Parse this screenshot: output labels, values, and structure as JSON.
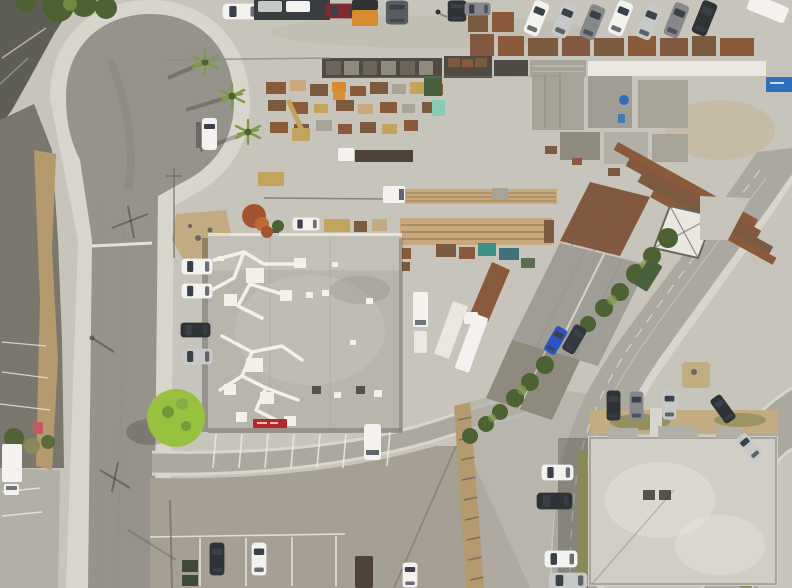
{
  "meta": {
    "subject": "Top-down aerial drone photograph of an industrial lumber yard and warehouse block with surrounding streets, a cul-de-sac, rooftops with HVAC ducting, and many parked vehicles",
    "view": "nadir (straight down)",
    "dimensions": "792x588"
  },
  "palette": {
    "concrete": "#c7c4bb",
    "concreteLight": "#d8d5cc",
    "concreteDark": "#b2afa6",
    "asphalt": "#96938c",
    "asphaltDark": "#7a776f",
    "hill": "#5f5e55",
    "lotBottom": "#a59f94",
    "roadDiag": "#aba8a0",
    "roofMain": "#b8b5ac",
    "roofLight": "#c6c3ba",
    "roofBR": "#d1cec5",
    "metalGray": "#a09d96",
    "metalDark": "#8f8a7e",
    "rustRoof": "#835840",
    "woodRust": "#8a5a3a",
    "lumberTan": "#c9a97c",
    "lumberBrown": "#7a5b40",
    "lumberGray": "#a8a399",
    "lumberDark": "#4f4a43",
    "duct": "#f1f0ea",
    "white": "#f3f2ee",
    "paleTrailer": "#e9e7e0",
    "silver": "#c7c8c8",
    "gray": "#86888c",
    "black": "#303336",
    "red": "#7e2a31",
    "orange": "#d78b2f",
    "blue": "#2b55c5",
    "teal": "#3e8f86",
    "tealDark": "#40707c",
    "greenTruck": "#49603f",
    "greenBin": "#3e4a38",
    "glass": "#3a4149",
    "shadow": "rgba(35,35,30,0.38)",
    "lineWhite": "#eceae3",
    "signRed": "#b3272d",
    "containerBlue": "#2e6fc0",
    "mint": "#84cdb2",
    "craneTan": "#c3a45c",
    "treeDark": "#4c6233",
    "treeLime": "#96c23f",
    "palm": "#7f9c48",
    "grassOlive": "#8a8a58",
    "dryBrush": "#b49a6c",
    "dirtTan": "#c3ac82",
    "pink": "#c25a66",
    "vent": "#55524b",
    "segGray": "#6b655b",
    "suvGray": "#595d61",
    "canopy": "#3b3e41",
    "trailerBrown": "#4e4239",
    "darkSuv": "#34383c",
    "treeRust": "#a4532e",
    "treeRustLight": "#c06a3a",
    "seam": "#8e8b84",
    "fenceDark": "#6a675f",
    "roadLine": "#cfccc2"
  },
  "signs": {
    "storefront_sign": {
      "color": "#b3272d",
      "text_legible": false
    },
    "shipping_container": {
      "color": "#2e6fc0",
      "text_legible": false
    }
  },
  "inventory": {
    "buildings": [
      "main warehouse with gray flat roof, white HVAC ducts and red storefront sign",
      "diagonal row of metal sheds (rust and gray corrugated roofs)",
      "white skylight shed",
      "light flat-roof office building at lower right with two roof vents",
      "long lumber racks and pallet rows in the yard"
    ],
    "vehicles": {
      "top_street": [
        "white pickup",
        "silver car under canopy",
        "white car under canopy",
        "red sedan",
        "orange flatbed truck with black cab",
        "gray SUV",
        "black car",
        "gray sedan",
        "7 angle-parked sedans",
        "partial white truck"
      ],
      "cul_de_sac": [
        "white cargo van"
      ],
      "west_parking_column": [
        "white SUV",
        "white sedan",
        "black sedan",
        "silver sedan"
      ],
      "yard": [
        "white semi with lumber flatbed",
        "white cab with dark flatbed trailer",
        "two white box trucks",
        "rust dump truck with white cab",
        "white pickup",
        "tan loader",
        "teal machinery",
        "excavator arm"
      ],
      "diagonal_street": [
        "green box truck",
        "blue sedan",
        "dark gray SUV"
      ],
      "bottom_lot": [
        "black sedan",
        "white sedan",
        "dark trailer",
        "white car",
        "two dark green dumpsters"
      ],
      "lower_right_building": [
        "black car",
        "gray car",
        "silver car (north row)",
        "white car",
        "black SUV",
        "white car (west lane)",
        "black car and silver car on curved road",
        "partial silver car at bottom edge"
      ]
    },
    "people": [
      "one pedestrian on the upper street"
    ],
    "vegetation": [
      "three palm trees by cul-de-sac",
      "bright lime-green tree",
      "rust-orange tree",
      "row of dark green trees along diagonal street",
      "dry brush strips",
      "olive grass strips"
    ]
  }
}
